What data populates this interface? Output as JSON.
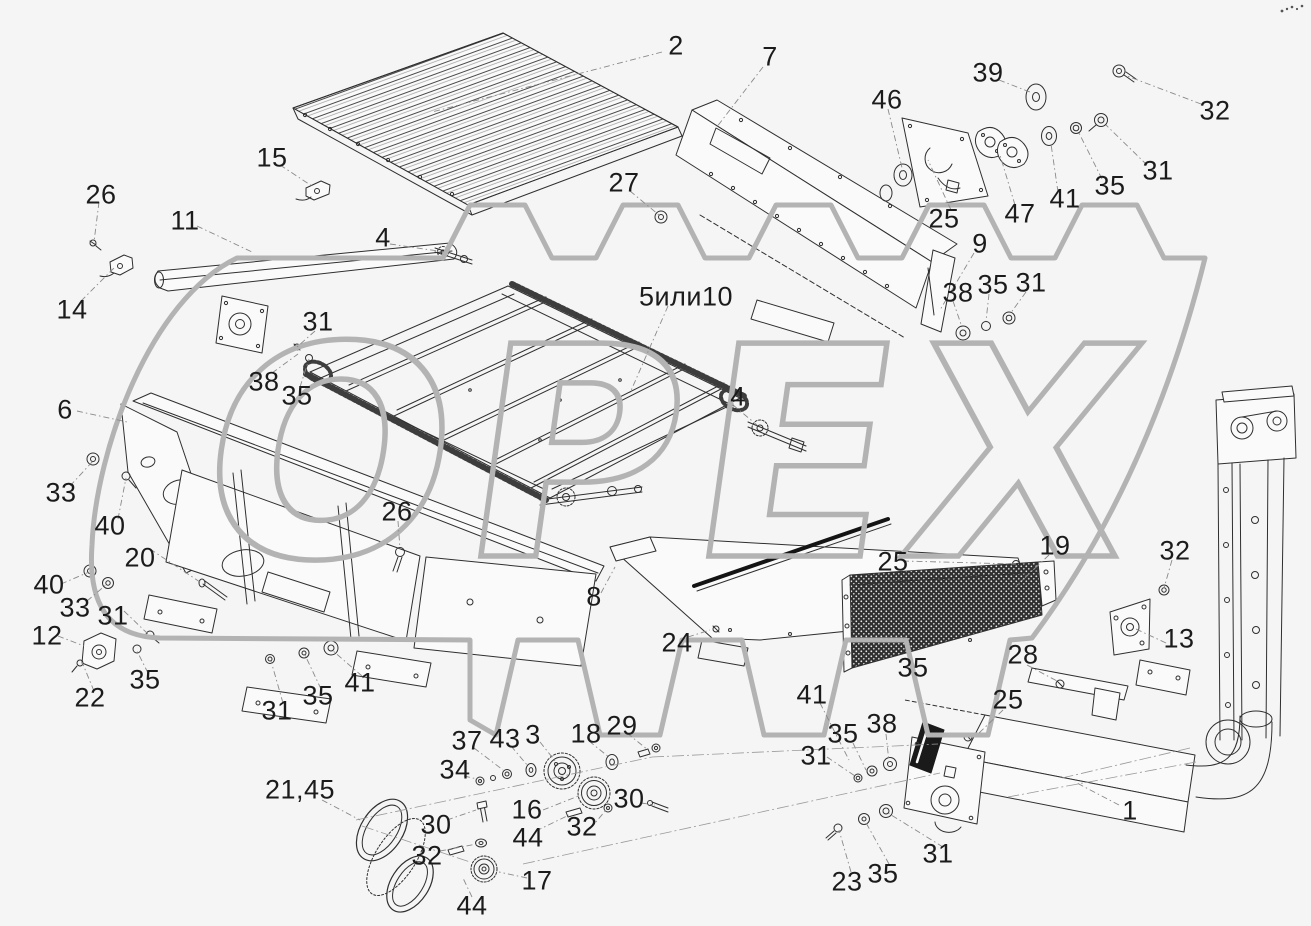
{
  "colors": {
    "background": "#f5f5f5",
    "line": "#2f2f2f",
    "label": "#1b1b1b",
    "watermark": "#b3b3b3",
    "mesh_dark": "#2f2f2f"
  },
  "watermark": {
    "text": "ОРЕХ"
  },
  "diagram": {
    "labels": [
      {
        "t": "2",
        "x": 676,
        "y": 46
      },
      {
        "t": "7",
        "x": 770,
        "y": 57
      },
      {
        "t": "39",
        "x": 988,
        "y": 73
      },
      {
        "t": "46",
        "x": 887,
        "y": 100
      },
      {
        "t": "32",
        "x": 1215,
        "y": 111
      },
      {
        "t": "31",
        "x": 1158,
        "y": 171
      },
      {
        "t": "35",
        "x": 1110,
        "y": 186
      },
      {
        "t": "41",
        "x": 1065,
        "y": 199
      },
      {
        "t": "47",
        "x": 1020,
        "y": 214
      },
      {
        "t": "25",
        "x": 944,
        "y": 219
      },
      {
        "t": "9",
        "x": 980,
        "y": 244
      },
      {
        "t": "27",
        "x": 624,
        "y": 183
      },
      {
        "t": "15",
        "x": 272,
        "y": 158
      },
      {
        "t": "26",
        "x": 101,
        "y": 195
      },
      {
        "t": "11",
        "x": 185,
        "y": 221
      },
      {
        "t": "14",
        "x": 72,
        "y": 310
      },
      {
        "t": "4",
        "x": 383,
        "y": 238
      },
      {
        "t": "5или10",
        "x": 686,
        "y": 297
      },
      {
        "t": "31",
        "x": 318,
        "y": 322
      },
      {
        "t": "38",
        "x": 264,
        "y": 382
      },
      {
        "t": "35",
        "x": 297,
        "y": 396
      },
      {
        "t": "38",
        "x": 958,
        "y": 293
      },
      {
        "t": "35",
        "x": 993,
        "y": 285
      },
      {
        "t": "31",
        "x": 1031,
        "y": 283
      },
      {
        "t": "4",
        "x": 738,
        "y": 397
      },
      {
        "t": "6",
        "x": 65,
        "y": 410
      },
      {
        "t": "33",
        "x": 61,
        "y": 493
      },
      {
        "t": "40",
        "x": 110,
        "y": 526
      },
      {
        "t": "20",
        "x": 140,
        "y": 558
      },
      {
        "t": "40",
        "x": 49,
        "y": 585
      },
      {
        "t": "33",
        "x": 75,
        "y": 608
      },
      {
        "t": "31",
        "x": 113,
        "y": 616
      },
      {
        "t": "12",
        "x": 47,
        "y": 636
      },
      {
        "t": "22",
        "x": 90,
        "y": 698
      },
      {
        "t": "35",
        "x": 145,
        "y": 680
      },
      {
        "t": "26",
        "x": 397,
        "y": 512
      },
      {
        "t": "8",
        "x": 594,
        "y": 597
      },
      {
        "t": "24",
        "x": 677,
        "y": 643
      },
      {
        "t": "25",
        "x": 893,
        "y": 562
      },
      {
        "t": "19",
        "x": 1055,
        "y": 546
      },
      {
        "t": "32",
        "x": 1175,
        "y": 551
      },
      {
        "t": "13",
        "x": 1179,
        "y": 639
      },
      {
        "t": "28",
        "x": 1023,
        "y": 655
      },
      {
        "t": "25",
        "x": 1008,
        "y": 700
      },
      {
        "t": "35",
        "x": 913,
        "y": 668
      },
      {
        "t": "41",
        "x": 812,
        "y": 695
      },
      {
        "t": "31",
        "x": 816,
        "y": 756
      },
      {
        "t": "35",
        "x": 843,
        "y": 734
      },
      {
        "t": "38",
        "x": 882,
        "y": 724
      },
      {
        "t": "31",
        "x": 938,
        "y": 854
      },
      {
        "t": "35",
        "x": 883,
        "y": 874
      },
      {
        "t": "23",
        "x": 847,
        "y": 882
      },
      {
        "t": "1",
        "x": 1130,
        "y": 811
      },
      {
        "t": "37",
        "x": 467,
        "y": 741
      },
      {
        "t": "43",
        "x": 505,
        "y": 739
      },
      {
        "t": "3",
        "x": 533,
        "y": 735
      },
      {
        "t": "18",
        "x": 586,
        "y": 734
      },
      {
        "t": "29",
        "x": 622,
        "y": 726
      },
      {
        "t": "34",
        "x": 455,
        "y": 770
      },
      {
        "t": "16",
        "x": 527,
        "y": 810
      },
      {
        "t": "30",
        "x": 629,
        "y": 799
      },
      {
        "t": "44",
        "x": 528,
        "y": 838
      },
      {
        "t": "32",
        "x": 582,
        "y": 827
      },
      {
        "t": "30",
        "x": 436,
        "y": 825
      },
      {
        "t": "32",
        "x": 427,
        "y": 856
      },
      {
        "t": "17",
        "x": 537,
        "y": 881
      },
      {
        "t": "44",
        "x": 472,
        "y": 906
      },
      {
        "t": "21,45",
        "x": 300,
        "y": 790
      },
      {
        "t": "31",
        "x": 277,
        "y": 711
      },
      {
        "t": "35",
        "x": 318,
        "y": 696
      },
      {
        "t": "41",
        "x": 360,
        "y": 683
      }
    ],
    "leaders": [
      [
        662,
        52,
        432,
        112
      ],
      [
        763,
        67,
        716,
        128
      ],
      [
        999,
        80,
        1030,
        92
      ],
      [
        1201,
        104,
        1127,
        76
      ],
      [
        888,
        109,
        903,
        172
      ],
      [
        1147,
        165,
        1106,
        125
      ],
      [
        1102,
        179,
        1079,
        133
      ],
      [
        1058,
        192,
        1051,
        144
      ],
      [
        1015,
        205,
        1000,
        155
      ],
      [
        951,
        210,
        928,
        160
      ],
      [
        974,
        253,
        940,
        310
      ],
      [
        630,
        191,
        659,
        215
      ],
      [
        280,
        165,
        312,
        186
      ],
      [
        99,
        202,
        94,
        242
      ],
      [
        197,
        226,
        252,
        252
      ],
      [
        81,
        301,
        116,
        266
      ],
      [
        390,
        244,
        438,
        251
      ],
      [
        668,
        306,
        630,
        393
      ],
      [
        315,
        331,
        297,
        347
      ],
      [
        272,
        373,
        298,
        354
      ],
      [
        300,
        387,
        309,
        359
      ],
      [
        953,
        301,
        962,
        327
      ],
      [
        989,
        294,
        986,
        321
      ],
      [
        1026,
        292,
        1010,
        314
      ],
      [
        733,
        405,
        757,
        425
      ],
      [
        77,
        411,
        127,
        422
      ],
      [
        70,
        486,
        93,
        461
      ],
      [
        118,
        519,
        126,
        478
      ],
      [
        150,
        549,
        203,
        584
      ],
      [
        61,
        584,
        89,
        572
      ],
      [
        87,
        601,
        107,
        584
      ],
      [
        124,
        611,
        148,
        634
      ],
      [
        58,
        636,
        84,
        646
      ],
      [
        94,
        691,
        82,
        662
      ],
      [
        148,
        673,
        137,
        651
      ],
      [
        398,
        521,
        400,
        549
      ],
      [
        283,
        703,
        271,
        661
      ],
      [
        321,
        689,
        305,
        655
      ],
      [
        362,
        676,
        332,
        650
      ],
      [
        601,
        593,
        615,
        567
      ],
      [
        688,
        637,
        710,
        630
      ],
      [
        903,
        561,
        1016,
        564
      ],
      [
        1049,
        555,
        1014,
        588
      ],
      [
        1172,
        560,
        1164,
        588
      ],
      [
        1166,
        643,
        1136,
        629
      ],
      [
        1027,
        665,
        1057,
        681
      ],
      [
        1003,
        710,
        978,
        734
      ],
      [
        820,
        703,
        849,
        760
      ],
      [
        853,
        743,
        866,
        770
      ],
      [
        886,
        734,
        889,
        762
      ],
      [
        827,
        757,
        855,
        776
      ],
      [
        851,
        872,
        839,
        830
      ],
      [
        889,
        864,
        865,
        821
      ],
      [
        943,
        847,
        888,
        813
      ],
      [
        1119,
        805,
        1075,
        782
      ],
      [
        474,
        748,
        503,
        770
      ],
      [
        511,
        746,
        528,
        766
      ],
      [
        540,
        742,
        556,
        762
      ],
      [
        589,
        741,
        610,
        758
      ],
      [
        627,
        733,
        648,
        750
      ],
      [
        464,
        776,
        477,
        779
      ],
      [
        543,
        810,
        581,
        795
      ],
      [
        641,
        803,
        655,
        805
      ],
      [
        536,
        831,
        569,
        815
      ],
      [
        590,
        829,
        606,
        810
      ],
      [
        447,
        820,
        476,
        810
      ],
      [
        440,
        851,
        477,
        844
      ],
      [
        527,
        878,
        499,
        872
      ],
      [
        472,
        897,
        463,
        878
      ],
      [
        322,
        800,
        360,
        820
      ]
    ],
    "axis_lines": [
      [
        356,
        820,
        652,
        757
      ],
      [
        523,
        864,
        940,
        773
      ],
      [
        652,
        757,
        938,
        744
      ],
      [
        362,
        826,
        470,
        862
      ],
      [
        1196,
        762,
        1008,
        797
      ],
      [
        1190,
        748,
        1062,
        778
      ]
    ]
  }
}
